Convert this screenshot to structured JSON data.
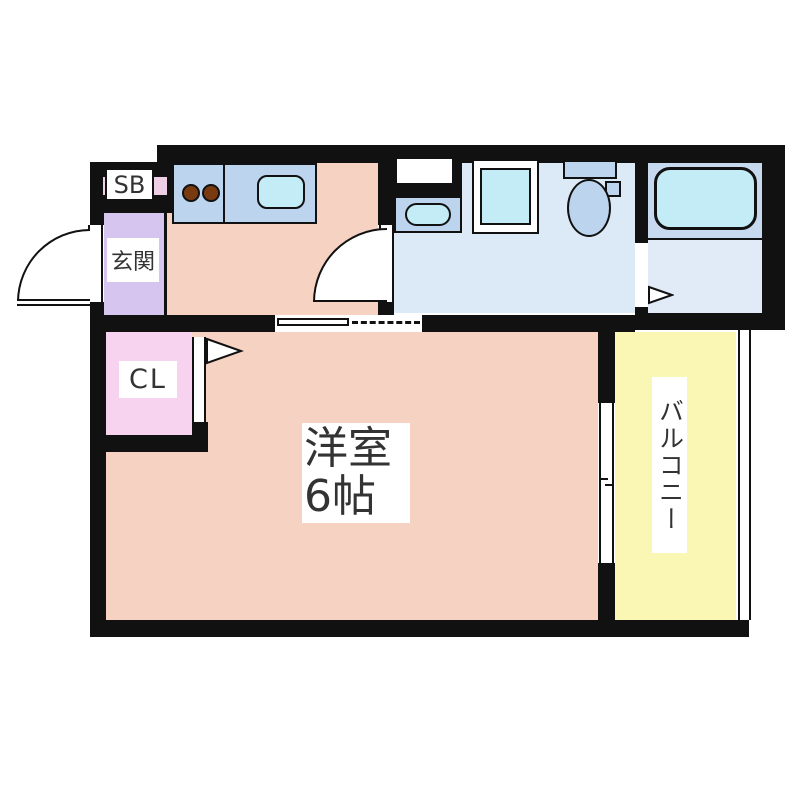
{
  "floorplan": {
    "rooms": {
      "shoe_box": {
        "label": "SB"
      },
      "entrance": {
        "label": "玄関"
      },
      "closet": {
        "label": "CL"
      },
      "western_room": {
        "label_line1": "洋室",
        "label_line2": "6帖"
      },
      "balcony": {
        "label": "バルコニー"
      }
    },
    "colors": {
      "wall": "#111111",
      "room_floor": "#f6d2c3",
      "entrance_floor": "#d6c5ee",
      "shoe_box_strip": "#efcfe6",
      "closet_floor": "#f8d3f0",
      "balcony_floor": "#faf7b4",
      "washroom_floor": "#dce9f6",
      "bathroom_floor": "#e0ebf7",
      "bath_platform": "#c7d9ef",
      "counter": "#bcd4ee",
      "fixture_fill": "#c3ecf6",
      "burner": "#7a3a10",
      "label_text": "#333333"
    }
  }
}
